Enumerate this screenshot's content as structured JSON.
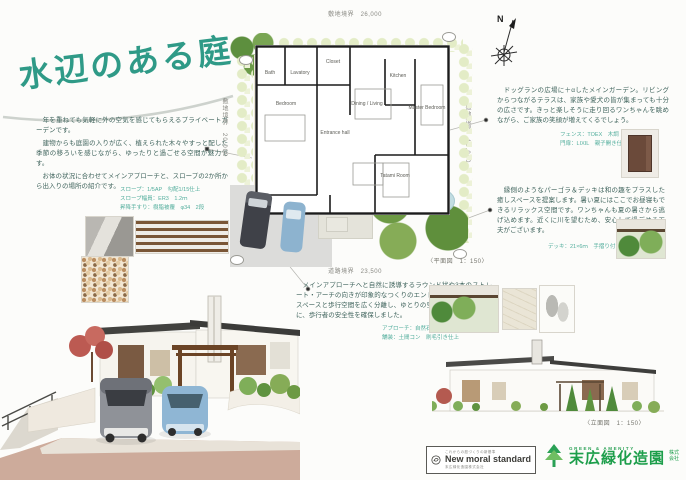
{
  "title": "水辺のある庭",
  "intro": {
    "p1": "　年を重ねても気軽に外の空気を感じてもらえるプライベートガーデンです。",
    "p2": "　建物からも庭園の入りが広く、植えられた木々やすっと配した季節の移ろいを感じながら、ゆったりと過ごせる空間が魅力です。",
    "p3": "　お体の状況に合わせてメインアプローチと、スロープの2か所から出入りの場所の紹介です。",
    "specs": [
      "スロープ：1/5AP　勾配1/15仕上",
      "スロープ幅員：ER3　1.2ｍ",
      "昇降手すり：樹脂被覆　φ34　2段"
    ]
  },
  "plan": {
    "dim_top": "敷地境界　26,000",
    "dim_bottom": "道路境界　23,500",
    "dim_left": "敷地境界　20,000",
    "dim_right": "敷地境界　16,000",
    "scale_label": "〈平面図　1：150〉",
    "compass_n": "N",
    "rooms": [
      {
        "label": "Bedroom"
      },
      {
        "label": "Bath"
      },
      {
        "label": "Lavatory"
      },
      {
        "label": "Closet"
      },
      {
        "label": "Entrance hall"
      },
      {
        "label": "Dining / Living"
      },
      {
        "label": "Kitchen"
      },
      {
        "label": "Master Bedroom"
      },
      {
        "label": "Tatami Room"
      }
    ]
  },
  "annotations": {
    "block1": {
      "text": "　ドッグランの広場に＋αしたメインガーデン。リビングからつながるテラスは、家族や愛犬の皆が集まっても十分の広さです。きっと楽しそうに走り回るワンちゃんを眺めながら、ご家族の笑顔が増えてくるでしょう。",
      "specs": [
        "フェンス：TOEX　木調",
        "門扉：LIXIL　親子開き仕様"
      ]
    },
    "block2": {
      "text": "　縁側のようなパーゴラ＆デッキは和の趣をプラスした癒しスペースを提案します。暑い夏にはここでお昼寝もできるリラックス空間です。ワンちゃんも夏の暑さから逃げ込めます。近くに川を望むため、安心して過ごせる工夫がございます。",
      "specs": [
        "デッキ：21×6ｍ　手摺り付"
      ]
    },
    "block3": {
      "text": "　メインアプローチへと自然に誘導するラウンド状や3本のストレート・アーチの向きが印象的なつくりのエントランス。また、駐車スペースと歩行空間を広く分離し、ゆとりの空間を確保するとともに、歩行者の安全性を確保しました。",
      "specs": [
        "アプローチ：自然石乱形貼り",
        "舗装：土間コン　刷毛引き仕上"
      ]
    }
  },
  "elevation": {
    "scale_label": "〈立面図　1：150〉"
  },
  "footer": {
    "badge": {
      "top": "これからの庭づくりの新基準",
      "main": "New moral standard",
      "bottom": "末広緑化造園株式会社"
    },
    "company": {
      "tagline": "GREEN & AMENITY",
      "name": "末広緑化造園",
      "suffix": "株式会社"
    }
  },
  "colors": {
    "accent": "#2f9a87",
    "spec_text": "#53ae9d",
    "logo_green": "#1d9e4b"
  }
}
